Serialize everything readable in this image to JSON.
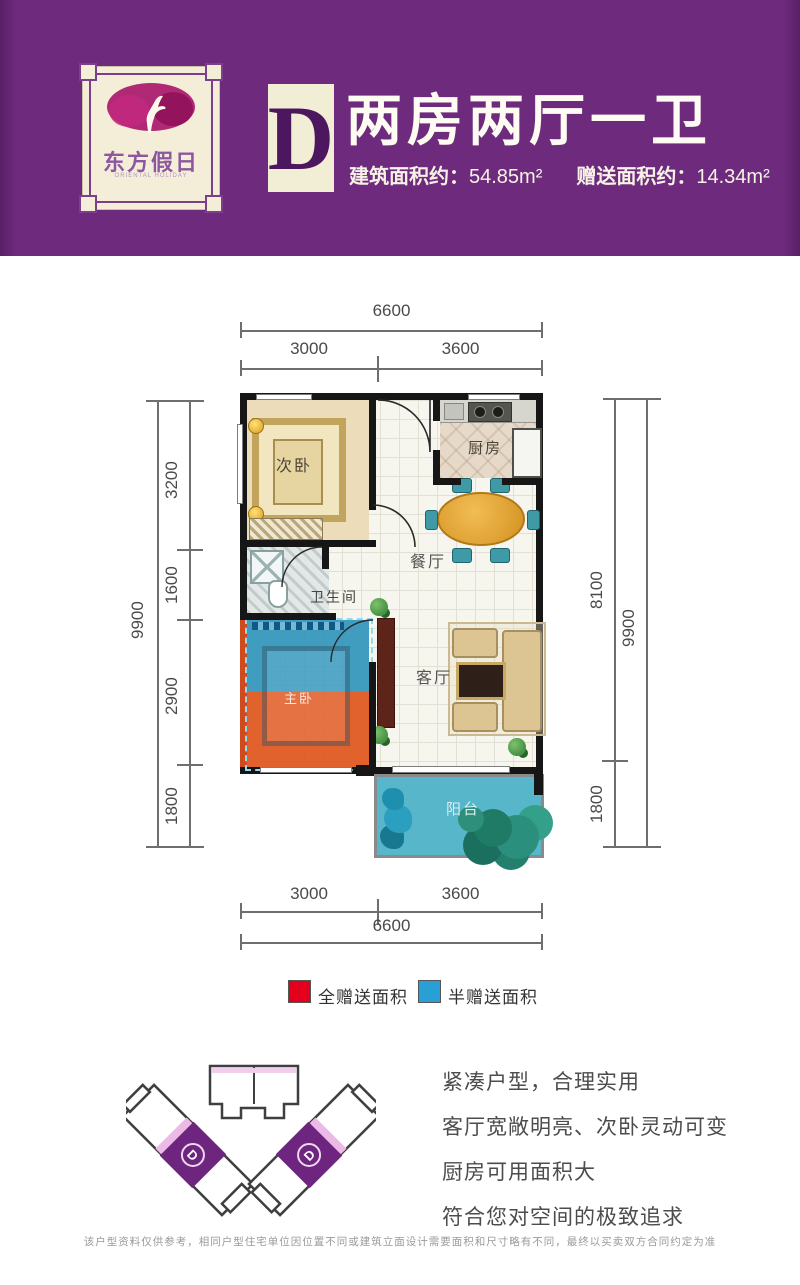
{
  "header": {
    "logo": {
      "brand": "东方假日",
      "brand_sub": "ORIENTAL HOLIDAY"
    },
    "unit_letter": "D",
    "title": "两房两厅一卫",
    "area_built_label": "建筑面积约：",
    "area_built_value": "54.85m²",
    "area_gift_label": "赠送面积约：",
    "area_gift_value": "14.34m²",
    "colors": {
      "header_purple": "#6e2b7e",
      "cream": "#f2edd5",
      "letter_purple": "#4d1760"
    }
  },
  "plan": {
    "rooms": {
      "bedroom2": "次卧",
      "kitchen": "厨房",
      "dining": "餐厅",
      "bathroom": "卫生间",
      "living": "客厅",
      "master": "主卧",
      "balcony": "阳台"
    },
    "dims": {
      "top_total": "6600",
      "top_left": "3000",
      "top_right": "3600",
      "left_total": "9900",
      "left_segments": [
        "3200",
        "1600",
        "2900",
        "1800"
      ],
      "right_segments": [
        "8100",
        "1800"
      ],
      "right_total": "9900",
      "bottom_left": "3000",
      "bottom_right": "3600",
      "bottom_total": "6600"
    },
    "highlight_colors": {
      "full_gift": "#e4001c",
      "half_gift": "#2a9fd6",
      "balcony_blue": "#58b6ca"
    }
  },
  "legend": {
    "items": [
      {
        "color": "#e4001c",
        "label": "全赠送面积"
      },
      {
        "color": "#2a9fd6",
        "label": "半赠送面积"
      }
    ]
  },
  "footprint": {
    "unit_marker": "D",
    "highlight_color": "#6e2580"
  },
  "description": {
    "lines": [
      "紧凑户型，合理实用",
      "客厅宽敞明亮、次卧灵动可变",
      "厨房可用面积大",
      "符合您对空间的极致追求"
    ]
  },
  "disclaimer": "该户型资料仅供参考，相同户型住宅单位因位置不同或建筑立面设计需要面积和尺寸略有不同，最终以买卖双方合同约定为准"
}
